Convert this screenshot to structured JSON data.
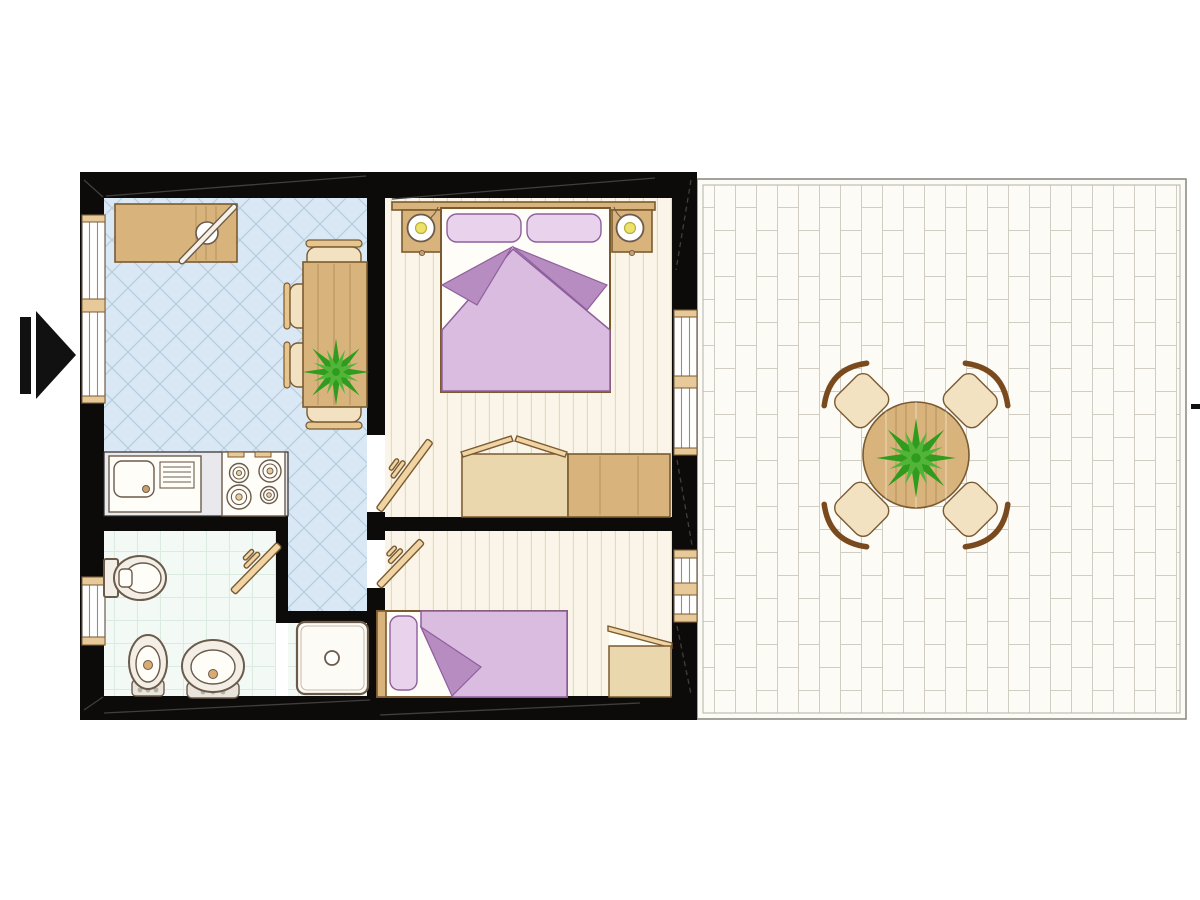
{
  "meta": {
    "type": "architectural-floor-plan",
    "description": "Top-view floor plan of a two-bedroom apartment with kitchen-dining room, bathroom, hallway and a large brick-paved terrace on the right; entrance arrow on the left, small scale tick on the right edge",
    "width_px": 1200,
    "height_px": 900
  },
  "colors": {
    "canvas_bg": "#ffffff",
    "wall": "#0d0b09",
    "kitchen_tile_bg": "#d9e8f4",
    "kitchen_tile_line": "#b7cede",
    "plank_bg": "#faf5e8",
    "plank_line": "#e4dac2",
    "bath_bg": "#f3f9f4",
    "bath_line": "#dcebe0",
    "terrace_bg": "#fcfbf6",
    "terrace_line": "#d2cdc2",
    "terrace_border": "#8f8d86",
    "wood": "#d9b37c",
    "wood_light": "#ead7ae",
    "wood_pale": "#f2e2c2",
    "wood_door": "#f0d4a4",
    "wood_border": "#7a5a30",
    "fixture_border": "#6b5b4b",
    "fixture_fill": "#f4efe6",
    "white": "#fffdf8",
    "counter_bg": "#e9e9ed",
    "purple_light": "#d9bce0",
    "purple_dark": "#b78cc1",
    "purple_pillow": "#e9d2ec",
    "purple_border": "#8f5f9d",
    "lamp_yellow": "#ece268",
    "plant_green": "#2f9c1d",
    "plant_green_light": "#52b53a",
    "arrow_black": "#111111"
  },
  "entrance": {
    "marker": "right-pointing-arrow",
    "side": "left wall"
  },
  "scale_tick": {
    "present": true,
    "side": "right edge, mid height"
  },
  "counts": {
    "windows": 4,
    "interior_doors": 3,
    "rooms": 5
  },
  "rooms": [
    {
      "id": "kitchen-dining",
      "floor": "light blue diagonal tiles",
      "furniture": [
        "worktop-desk",
        "dining-table",
        "dining-chair-x4",
        "potted-plant",
        "sink-unit-with-drainer",
        "stove-4-burners",
        "hallway-corridor"
      ]
    },
    {
      "id": "bathroom",
      "floor": "white square tiles",
      "furniture": [
        "toilet",
        "bidet",
        "washbasin",
        "shower-tray",
        "door-leaf",
        "window"
      ]
    },
    {
      "id": "bedroom-master",
      "floor": "cream wood planks",
      "furniture": [
        "double-bed",
        "pillow-x2",
        "purple-blanket",
        "nightstand-x2",
        "bedside-lamp-x2",
        "wardrobe-open",
        "wardrobe-closed",
        "door-leaf",
        "window"
      ]
    },
    {
      "id": "bedroom-second",
      "floor": "cream wood planks",
      "furniture": [
        "single-bed",
        "pillow",
        "purple-blanket",
        "wardrobe-open",
        "door-leaf",
        "window"
      ]
    },
    {
      "id": "terrace",
      "floor": "white vertical brick paving",
      "furniture": [
        "round-wooden-table",
        "terrace-chair-x4",
        "potted-plant"
      ]
    }
  ]
}
